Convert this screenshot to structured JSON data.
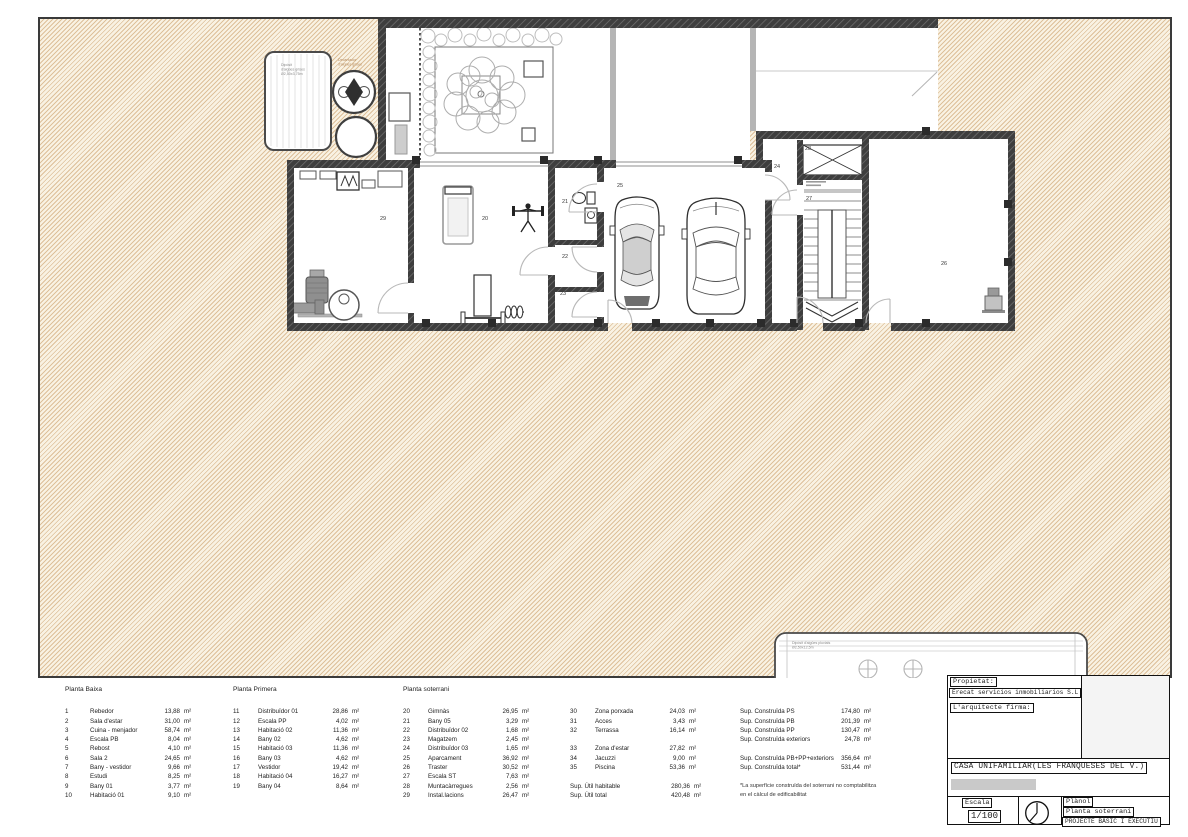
{
  "colors": {
    "site_fill": "#f9f2e3",
    "site_hatch": "#ddc09a",
    "wall": "#3e3e3e",
    "redacted_bar": "#c9c9c9"
  },
  "plan": {
    "room_numbers": {
      "gimnas": "20",
      "bany05": "21",
      "distribuidor02": "22",
      "magatzem": "23",
      "distribuidor03": "24",
      "aparcament": "25",
      "traster": "26",
      "escala_st": "27",
      "muntacarregues": "28",
      "instal_lacions": "29"
    },
    "annotations": {
      "diposit_grises": [
        "Dipòsit",
        "d'aigües grises",
        "Ø2,50x3,75m"
      ],
      "decantador": [
        "Decantador",
        "d'aigües grises"
      ],
      "diposit_pluvials": [
        "Dipòsit d'aigües pluvials",
        "Ø2,50x12,5m"
      ]
    }
  },
  "legend": {
    "groups": [
      {
        "header": "Planta Baixa",
        "rows": [
          {
            "num": "1",
            "name": "Rebedor",
            "value": "13,88",
            "unit": "m²"
          },
          {
            "num": "2",
            "name": "Sala d'estar",
            "value": "31,00",
            "unit": "m²"
          },
          {
            "num": "3",
            "name": "Cuina - menjador",
            "value": "58,74",
            "unit": "m²"
          },
          {
            "num": "4",
            "name": "Escala PB",
            "value": "8,04",
            "unit": "m²"
          },
          {
            "num": "5",
            "name": "Rebost",
            "value": "4,10",
            "unit": "m²"
          },
          {
            "num": "6",
            "name": "Sala 2",
            "value": "24,65",
            "unit": "m²"
          },
          {
            "num": "7",
            "name": "Bany - vestidor",
            "value": "9,66",
            "unit": "m²"
          },
          {
            "num": "8",
            "name": "Estudi",
            "value": "8,25",
            "unit": "m²"
          },
          {
            "num": "9",
            "name": "Bany 01",
            "value": "3,77",
            "unit": "m²"
          },
          {
            "num": "10",
            "name": "Habitació 01",
            "value": "9,10",
            "unit": "m²"
          }
        ]
      },
      {
        "header": "Planta Primera",
        "rows": [
          {
            "num": "11",
            "name": "Distribuïdor 01",
            "value": "28,86",
            "unit": "m²"
          },
          {
            "num": "12",
            "name": "Escala PP",
            "value": "4,02",
            "unit": "m²"
          },
          {
            "num": "13",
            "name": "Habitació 02",
            "value": "11,36",
            "unit": "m²"
          },
          {
            "num": "14",
            "name": "Bany 02",
            "value": "4,62",
            "unit": "m²"
          },
          {
            "num": "15",
            "name": "Habitació 03",
            "value": "11,36",
            "unit": "m²"
          },
          {
            "num": "16",
            "name": "Bany 03",
            "value": "4,62",
            "unit": "m²"
          },
          {
            "num": "17",
            "name": "Vestidor",
            "value": "19,42",
            "unit": "m²"
          },
          {
            "num": "18",
            "name": "Habitació 04",
            "value": "16,27",
            "unit": "m²"
          },
          {
            "num": "19",
            "name": "Bany 04",
            "value": "8,64",
            "unit": "m²"
          }
        ]
      },
      {
        "header": "Planta soterrani",
        "rows": [
          {
            "num": "20",
            "name": "Gimnàs",
            "value": "26,95",
            "unit": "m²"
          },
          {
            "num": "21",
            "name": "Bany 05",
            "value": "3,29",
            "unit": "m²"
          },
          {
            "num": "22",
            "name": "Distribuïdor 02",
            "value": "1,68",
            "unit": "m²"
          },
          {
            "num": "23",
            "name": "Magatzem",
            "value": "2,45",
            "unit": "m²"
          },
          {
            "num": "24",
            "name": "Distribuïdor 03",
            "value": "1,65",
            "unit": "m²"
          },
          {
            "num": "25",
            "name": "Aparcament",
            "value": "36,92",
            "unit": "m²"
          },
          {
            "num": "26",
            "name": "Traster",
            "value": "30,52",
            "unit": "m²"
          },
          {
            "num": "27",
            "name": "Escala ST",
            "value": "7,63",
            "unit": "m²"
          },
          {
            "num": "28",
            "name": "Muntacàrregues",
            "value": "2,56",
            "unit": "m²"
          },
          {
            "num": "29",
            "name": "Instal.lacions",
            "value": "26,47",
            "unit": "m²"
          }
        ]
      },
      {
        "header": "",
        "rows": [
          {
            "num": "30",
            "name": "Zona porxada",
            "value": "24,03",
            "unit": "m²"
          },
          {
            "num": "31",
            "name": "Acces",
            "value": "3,43",
            "unit": "m²"
          },
          {
            "num": "32",
            "name": "Terrassa",
            "value": "16,14",
            "unit": "m²"
          },
          {
            "spacer": true
          },
          {
            "num": "33",
            "name": "Zona d'estar",
            "value": "27,82",
            "unit": "m²"
          },
          {
            "num": "34",
            "name": "Jacuzzi",
            "value": "9,00",
            "unit": "m²"
          },
          {
            "num": "35",
            "name": "Piscina",
            "value": "53,36",
            "unit": "m²"
          },
          {
            "spacer": true
          },
          {
            "label": "Sup. Útil habitable",
            "value": "280,36",
            "unit": "m²"
          },
          {
            "label": "Sup. Útil total",
            "value": "420,48",
            "unit": "m²"
          }
        ]
      },
      {
        "header": "",
        "rows": [
          {
            "label": "Sup. Construïda PS",
            "value": "174,80",
            "unit": "m²"
          },
          {
            "label": "Sup. Construïda PB",
            "value": "201,39",
            "unit": "m²"
          },
          {
            "label": "Sup. Construïda PP",
            "value": "130,47",
            "unit": "m²"
          },
          {
            "label": "Sup. Construïda exteriors",
            "value": "24,78",
            "unit": "m²"
          },
          {
            "spacer": true
          },
          {
            "label": "Sup. Construïda PB+PP+exteriors",
            "value": "356,64",
            "unit": "m²"
          },
          {
            "label": "Sup. Construïda total*",
            "value": "531,44",
            "unit": "m²"
          },
          {
            "spacer": true
          },
          {
            "note": "*La superfície construïda del soterrani no comptabilitza"
          },
          {
            "note": "en el càlcul de edificabilitat"
          }
        ]
      }
    ]
  },
  "titleblock": {
    "propietat_label": "Propietat:",
    "propietat_value": "Erecat servicios inmobiliarios S.L",
    "arquitecte_label": "L'arquitecte firma:",
    "project_title": "CASA UNIFAMILIAR(LES FRANQUESES DEL V.)",
    "escala_label": "Escala",
    "escala_value": "1/100",
    "planol_label": "Plànol",
    "planol_value": "Planta soterrani",
    "project_phase": "PROJECTE BÀSIC I EXECUTIU"
  }
}
